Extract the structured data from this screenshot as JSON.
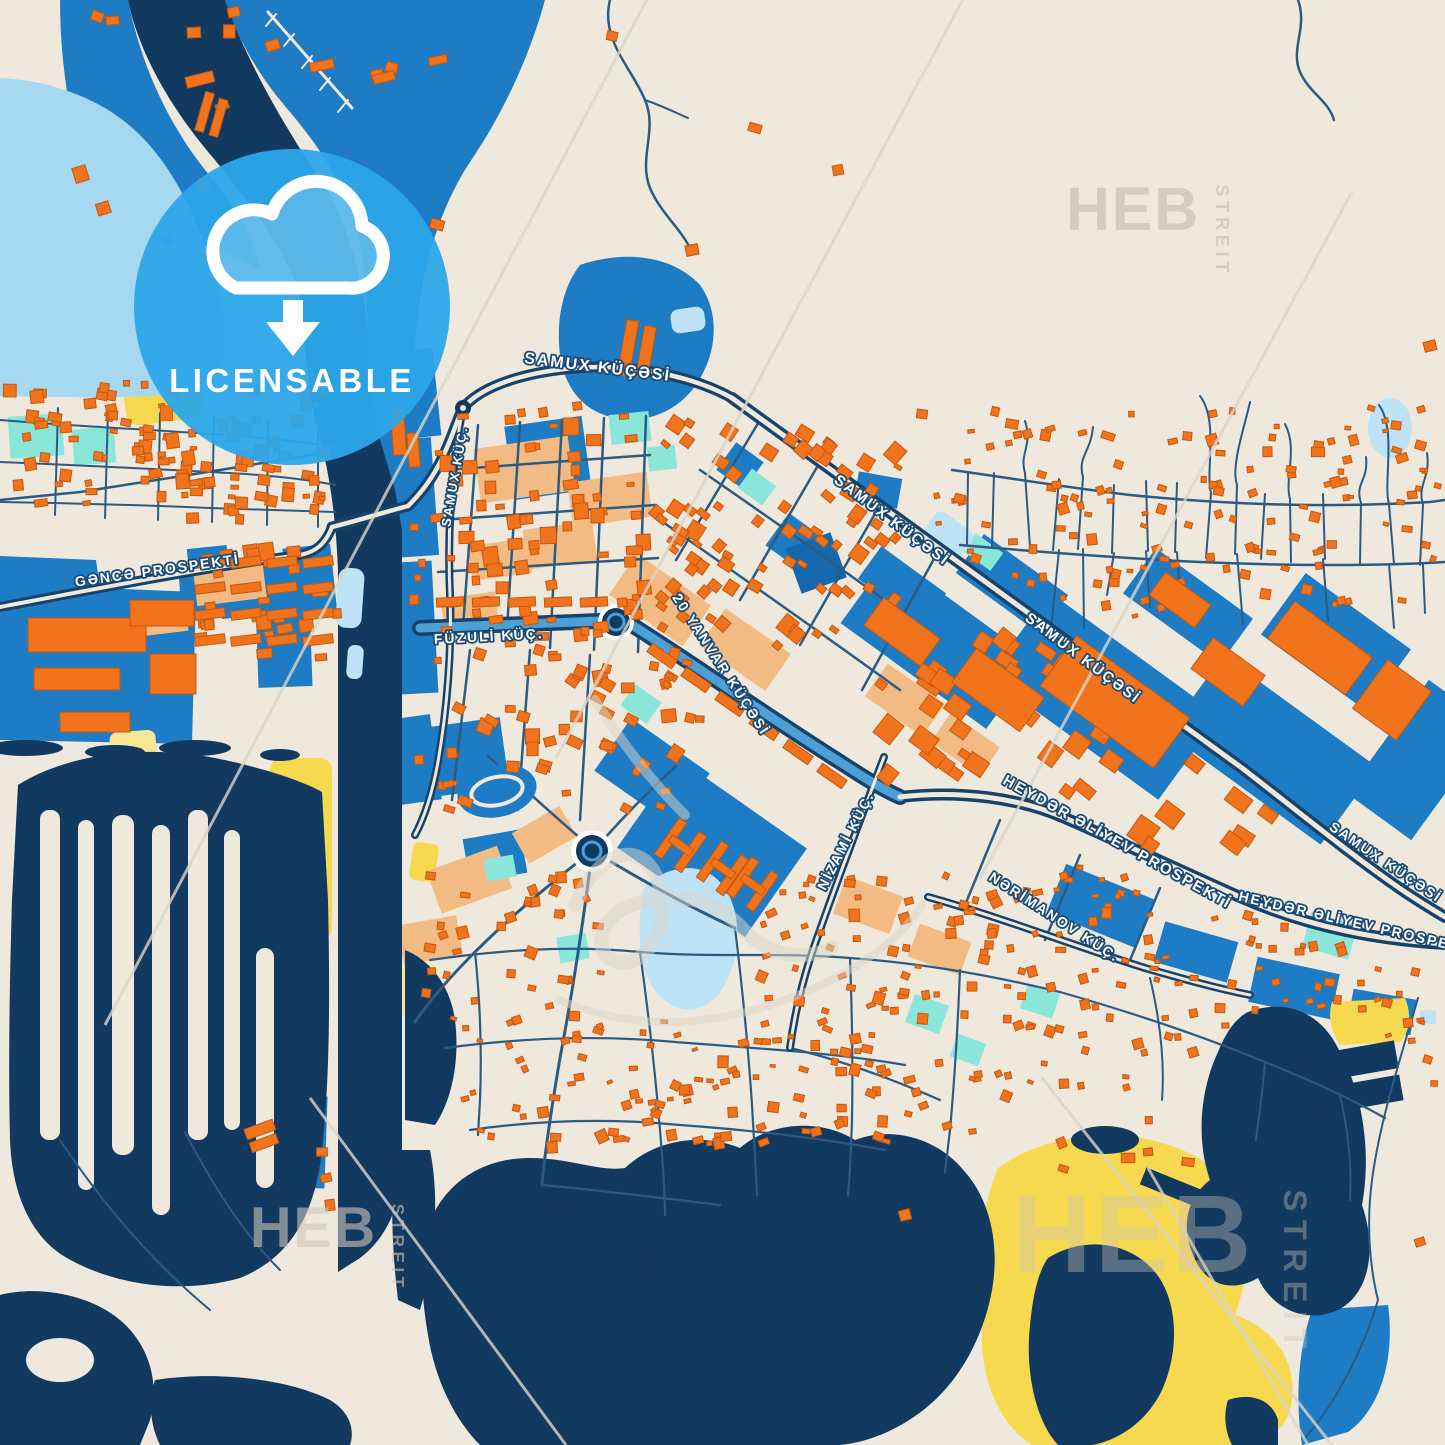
{
  "poster": {
    "width": 1445,
    "height": 1445,
    "kind": "city-map-poster"
  },
  "badge": {
    "label": "LICENSABLE",
    "icon": "cloud-download-icon",
    "color": "#2CA6E9"
  },
  "brand_watermark": {
    "main": "HEB",
    "side": "STREIT",
    "instances": [
      {
        "x": 1066,
        "y": 230,
        "scale": 0.95,
        "opacity": 0.8
      },
      {
        "x": 250,
        "y": 1247,
        "scale": 0.9,
        "opacity": 0.6
      },
      {
        "x": 1012,
        "y": 1272,
        "scale": 1.72,
        "opacity": 0.38
      }
    ]
  },
  "street_labels": [
    {
      "text": "SAMUX KÜÇƏSİ",
      "x": 597,
      "y": 372,
      "rot": 7,
      "size": 16
    },
    {
      "text": "SAMUX KÜÇ.",
      "x": 459,
      "y": 477,
      "rot": -80,
      "size": 13
    },
    {
      "text": "SAMUX KÜÇƏSİ",
      "x": 889,
      "y": 524,
      "rot": 37,
      "size": 15
    },
    {
      "text": "SAMUX KÜÇƏSİ",
      "x": 1080,
      "y": 662,
      "rot": 37,
      "size": 15
    },
    {
      "text": "SAMUX KÜÇƏSİ",
      "x": 1383,
      "y": 866,
      "rot": 34,
      "size": 14
    },
    {
      "text": "GƏNCƏ PROSPEKTİ",
      "x": 158,
      "y": 575,
      "rot": -8,
      "size": 14
    },
    {
      "text": "FÜZULİ KÜÇ.",
      "x": 489,
      "y": 641,
      "rot": -3,
      "size": 14
    },
    {
      "text": "20 YANVAR KÜÇƏSİ",
      "x": 717,
      "y": 667,
      "rot": 57,
      "size": 14
    },
    {
      "text": "NİZAMİ KÜÇ.",
      "x": 850,
      "y": 843,
      "rot": -63,
      "size": 14
    },
    {
      "text": "HEYDƏR ƏLİYEV PROSPEKTİ",
      "x": 1115,
      "y": 846,
      "rot": 29,
      "size": 15
    },
    {
      "text": "NƏRİMANOV KÜÇ.",
      "x": 1052,
      "y": 921,
      "rot": 33,
      "size": 14
    },
    {
      "text": "HEYDƏR ƏLİYEV PROSPEKTİ",
      "x": 1357,
      "y": 928,
      "rot": 13,
      "size": 14
    }
  ],
  "palette": {
    "cream": "#EFE8DC",
    "water": "#12395F",
    "road": "#17436B",
    "road_thin": "#2B5B83",
    "azure": "#1D7CC4",
    "azure_dark": "#1668AC",
    "azure_light": "#4D9FD6",
    "light_blue": "#A6D8F2",
    "pond": "#BFE3F6",
    "cyan": "#8AE6D9",
    "yellow": "#F6D94F",
    "pale_yellow": "#F8E795",
    "peach": "#F2BB83",
    "orange": "#F1731C",
    "orange_dark": "#C5570F",
    "badge_blue": "#2CA6E9",
    "watermark_grey": "#CDC6B8",
    "hairline": "#DBD5C8",
    "label_halo": "#1A4A74"
  }
}
